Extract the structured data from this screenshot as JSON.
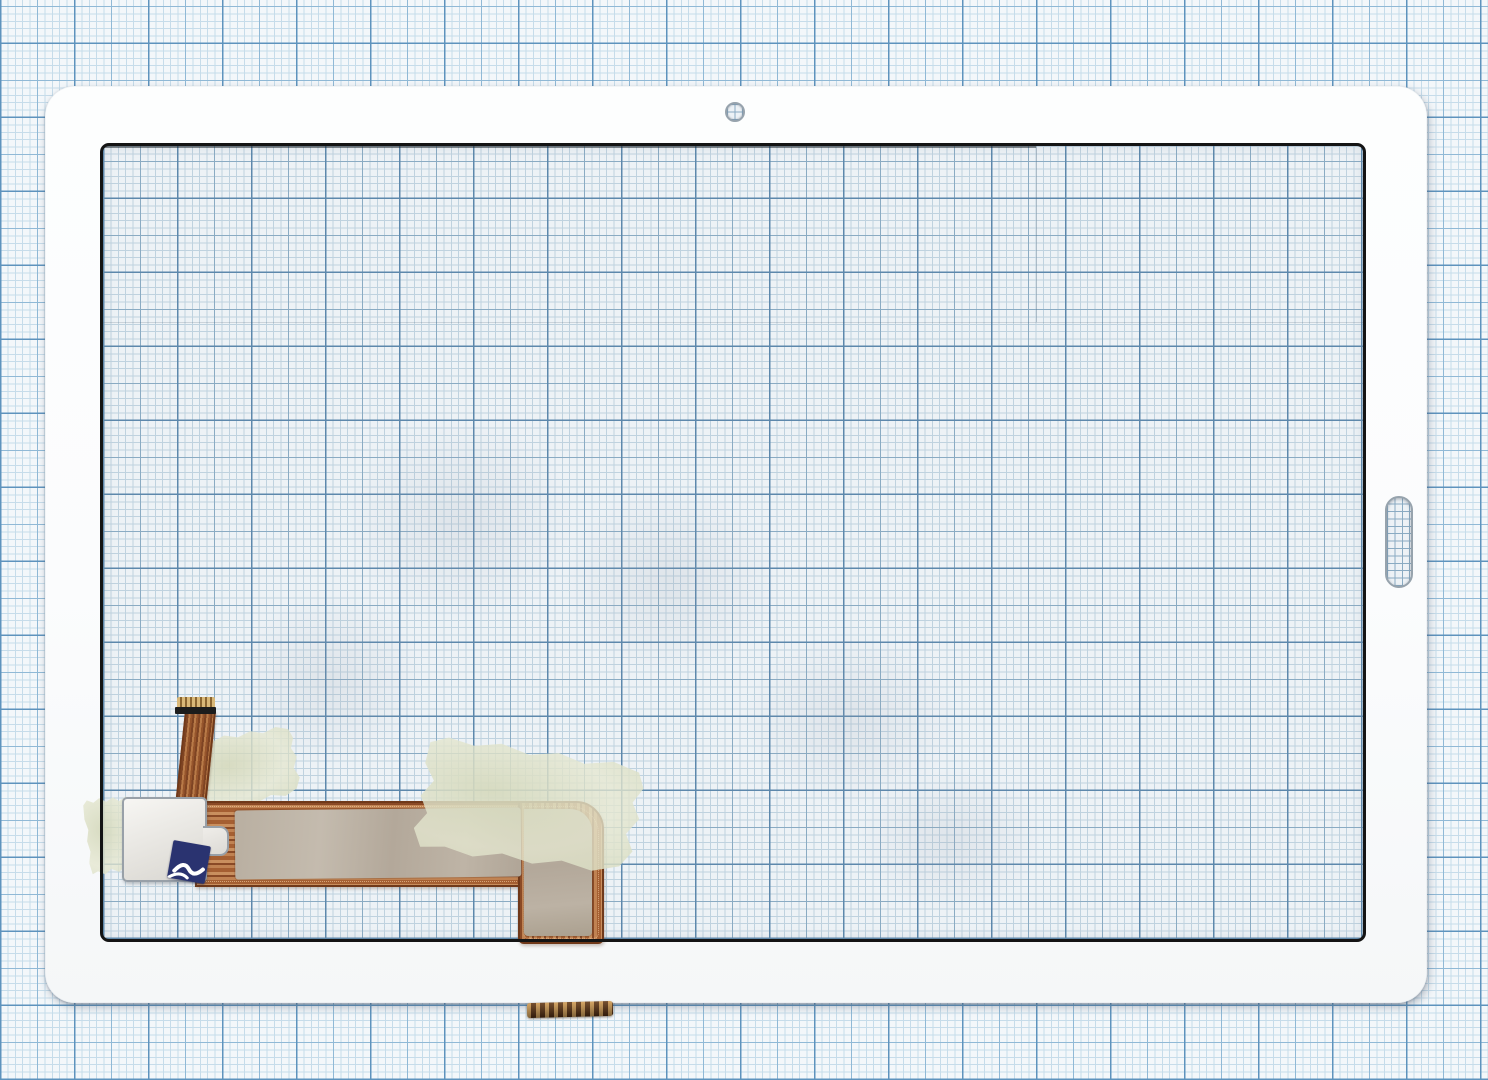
{
  "scene": {
    "type": "scanned product photo",
    "subject": "White tablet touchscreen digitizer glass panel lying on blue millimeter graph paper",
    "objects": {
      "graph_paper": "blue millimeter grid paper background with 1mm, 5mm and 10mm lines",
      "digitizer_panel": "white-bezel glass touch panel with rounded corners",
      "viewing_window": "transparent glass area with printed black border, grid visible through the glass",
      "camera_hole": "small round front-camera opening in the top bezel",
      "home_button_slot": "vertical pill-shaped home/fingerprint cutout in the right bezel",
      "ribbon_cable": "narrow vertical copper flex ribbon with gold contact fingers and black stiffener",
      "main_flex_cable": "L-shaped copper flex cable running along the lower left, turning down to the bottom edge",
      "shield_film": "grey-beige shielding film covering most of the main flex cable",
      "white_pad": "white foam pad with silver edge and small side tab over the flex junction",
      "blue_sticker": "dark navy adhesive sticker with white logo at the pad corner",
      "tape_left": "small translucent paper tape piece left of the pad",
      "tape_top": "translucent paper tape piece beside the ribbon cable",
      "tape_right": "large slanted translucent paper tape piece with torn edges",
      "connector_tail": "dark copper connector tail with gold contacts protruding below the bottom bezel"
    }
  },
  "colors": {
    "paper-bg": "#f3f7fa",
    "grid-fine": "#c6dcea",
    "grid-mid": "#90b9d6",
    "grid-bold": "#5e93bd",
    "glass-bg": "#edf2f6",
    "glass-fine": "#bfd2df",
    "glass-mid": "#8aabc3",
    "glass-bold": "#5d88ac",
    "bezel": "#fbfcfd",
    "window-border": "#141414",
    "hole-ring": "#97a3ad",
    "copper": "#b06a3e",
    "copper-dark": "#70391a",
    "gold": "#d9b878",
    "stiffener": "#1c1c1c",
    "shield": "#b5aa9c",
    "pad-border": "#98a0a8",
    "sticker": "#2a3370",
    "tape": "#e4e5d0",
    "tail-dark": "#4a2810",
    "tail-gold": "#c89a58"
  }
}
